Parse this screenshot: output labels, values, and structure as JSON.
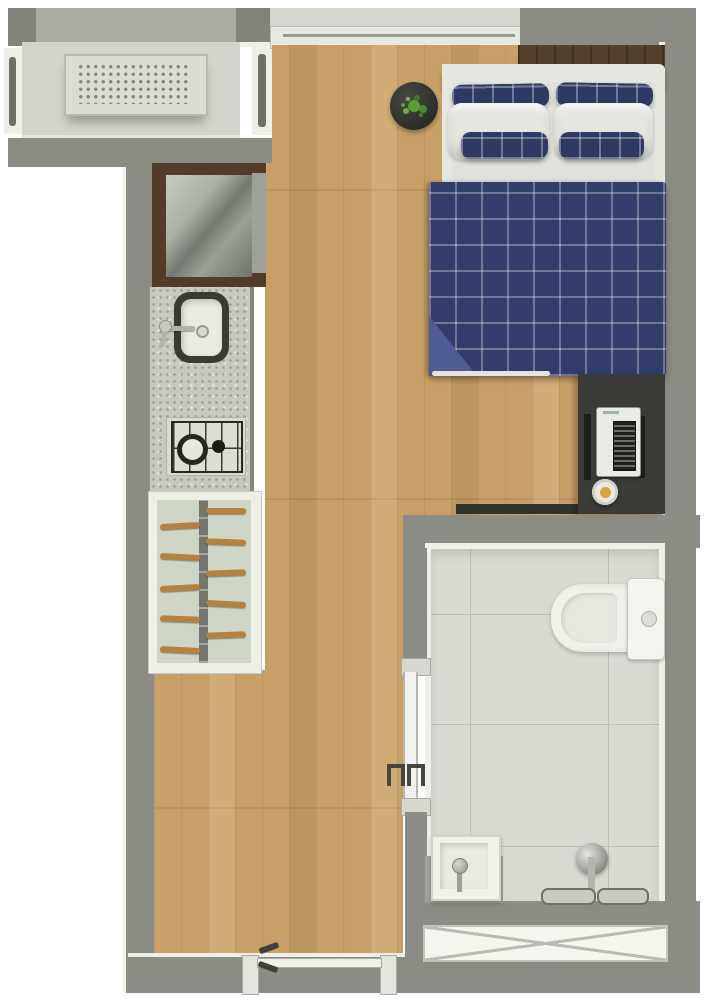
{
  "document": {
    "type": "floor-plan",
    "style": "photorealistic top-down render of a studio apartment",
    "text_labels": []
  },
  "colors": {
    "wall": "#8b8c84",
    "wall_dark": "#82837b",
    "wall_light": "#a9aaa2",
    "edge_white": "#eef0e8",
    "balcony_floor": "#d2d3cb",
    "wood": "#c89f67",
    "wood_panel_dark": "#54402c",
    "tile": "#d8dad2",
    "grout": "#bcbeb6",
    "navy": "#333d6b",
    "navy_fold": "#515b93",
    "bedding_white": "#e6e6e0",
    "fridge_wood": "#523d2a",
    "granite": "#c7c9c1",
    "desk_charcoal": "#3b3b37",
    "appliance_white": "#e9eae4",
    "rung_wood": "#b5813f",
    "rack_bg": "#ced5c7",
    "fixture_white": "#f0f1eb",
    "chrome": "#b0b2aa",
    "plant_green": "#4c8a33",
    "bowl_yellow": "#d9a43a"
  },
  "rooms": {
    "service_balcony": {
      "furniture": [
        "ac-condenser",
        "louver-vent-left",
        "louver-vent-right"
      ]
    },
    "kitchen": {
      "furniture": [
        "refrigerator",
        "countertop-sink",
        "faucet",
        "two-burner-cooktop",
        "drying-rack"
      ]
    },
    "living_bedroom": {
      "furniture": [
        "double-bed-plaid-bedding",
        "plaid-pillows",
        "white-pillows",
        "plant-side-table",
        "headboard-panel",
        "desk-sideboard",
        "desk-appliance",
        "bowl",
        "top-window"
      ]
    },
    "bathroom": {
      "furniture": [
        "toilet",
        "washbasin",
        "shower-head",
        "shower-grab-bars",
        "sliding-door",
        "ventilation-window"
      ]
    },
    "entry": {
      "furniture": [
        "entry-door"
      ]
    }
  }
}
